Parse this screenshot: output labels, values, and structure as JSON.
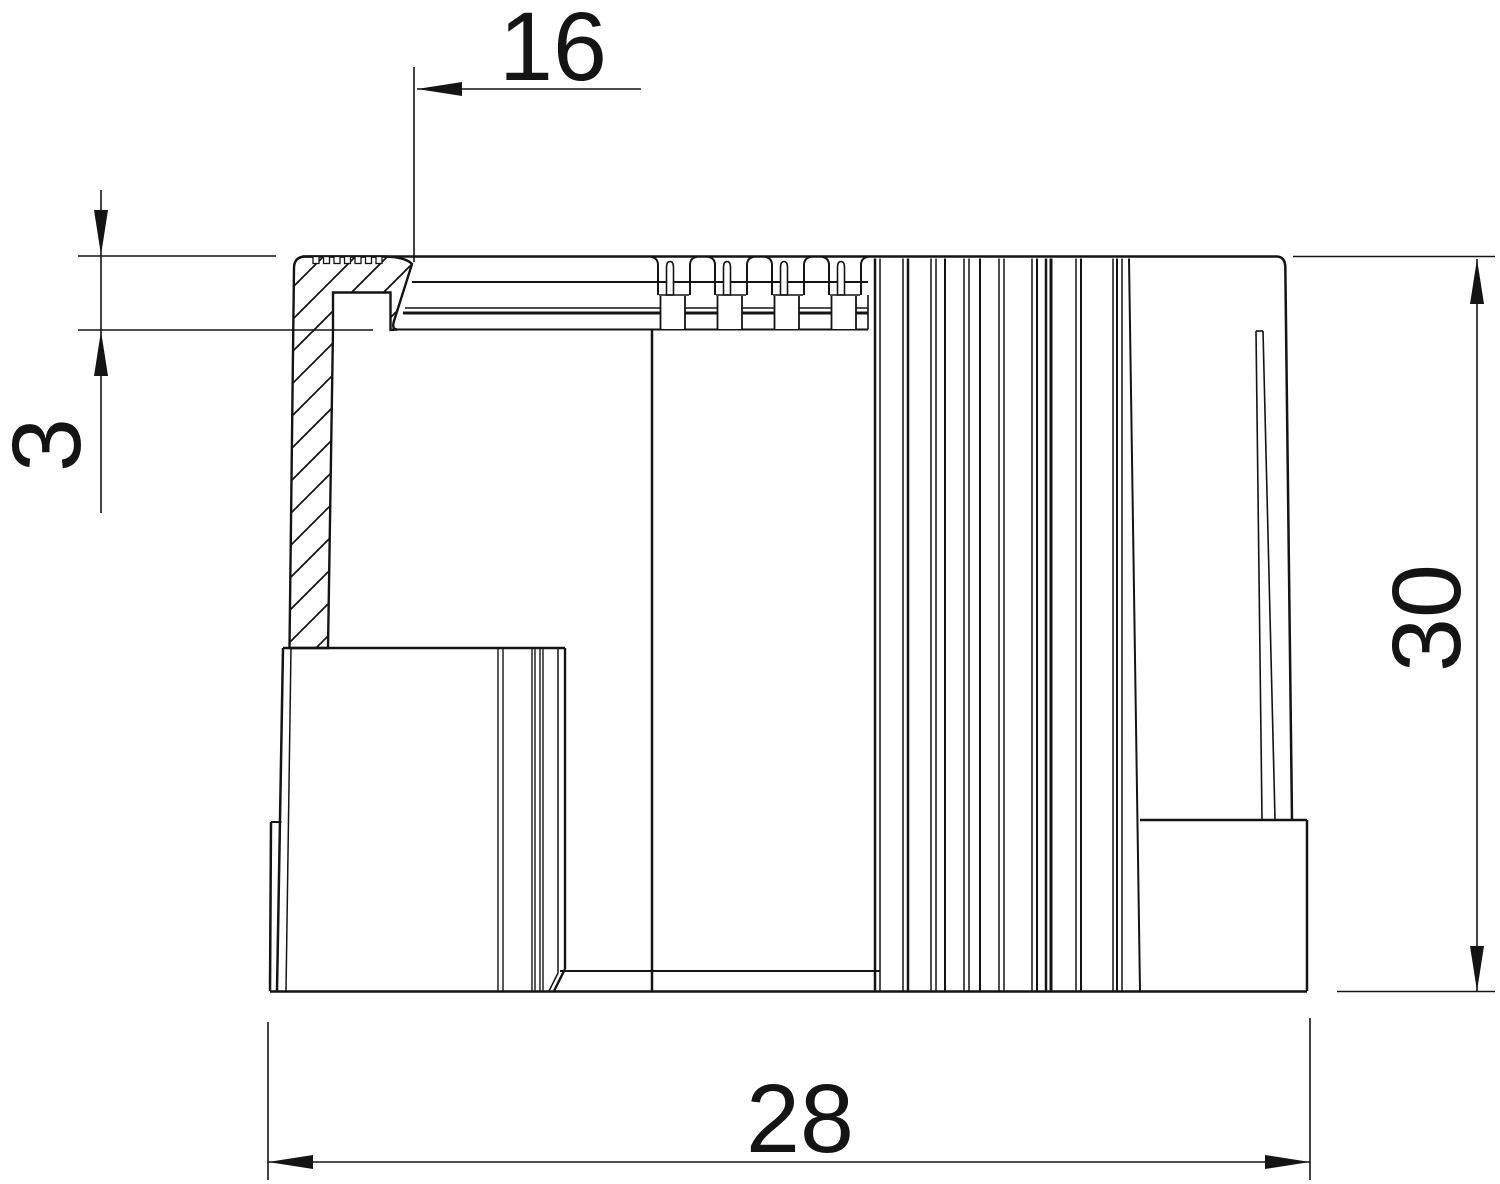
{
  "drawing": {
    "kind": "technical-section-drawing",
    "part": "end-cap-cross-section",
    "colors": {
      "line": "#141414",
      "background": "#ffffff"
    },
    "dimensions": {
      "inner_offset": {
        "value": "16",
        "orientation": "horizontal",
        "position": "top"
      },
      "flange_thickness": {
        "value": "3",
        "orientation": "vertical",
        "position": "left"
      },
      "overall_height": {
        "value": "30",
        "orientation": "vertical",
        "position": "right"
      },
      "overall_width": {
        "value": "28",
        "orientation": "horizontal",
        "position": "bottom"
      }
    }
  }
}
